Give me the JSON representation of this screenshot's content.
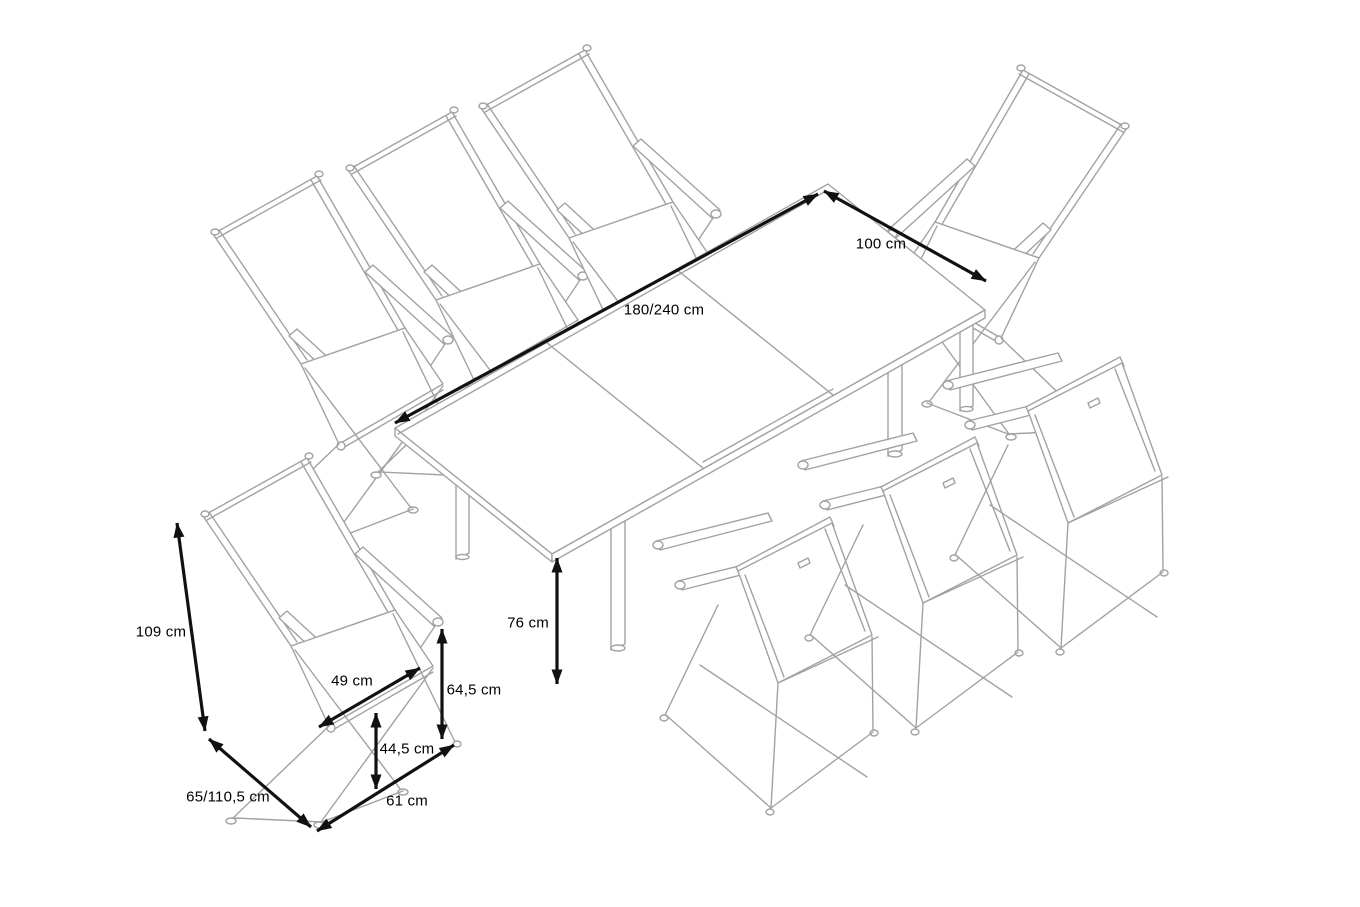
{
  "figure": {
    "type": "isometric product dimension line drawing",
    "subject": "extendable garden dining table with 8 folding high-back chairs",
    "background_color": "#ffffff",
    "line_color": "#a2a2a2",
    "dimension_color": "#111111"
  },
  "objects": {
    "table": "extendable rectangular dining table with extension leaf",
    "chair_count": 8,
    "chair_type": "folding high-back armchair"
  },
  "dimensions": {
    "table_length": {
      "label": "180/240 cm",
      "measures": "table length (normal/extended)"
    },
    "table_width": {
      "label": "100 cm",
      "measures": "table width"
    },
    "table_height": {
      "label": "76 cm",
      "measures": "table height"
    },
    "chair_height": {
      "label": "109 cm",
      "measures": "chair back height"
    },
    "seat_width": {
      "label": "49 cm",
      "measures": "seat width"
    },
    "armrest_height": {
      "label": "64,5 cm",
      "measures": "armrest height"
    },
    "seat_height": {
      "label": "44,5 cm",
      "measures": "seat height"
    },
    "chair_width": {
      "label": "61 cm",
      "measures": "chair width"
    },
    "chair_depth": {
      "label": "65/110,5 cm",
      "measures": "chair depth (upright/reclined)"
    }
  }
}
